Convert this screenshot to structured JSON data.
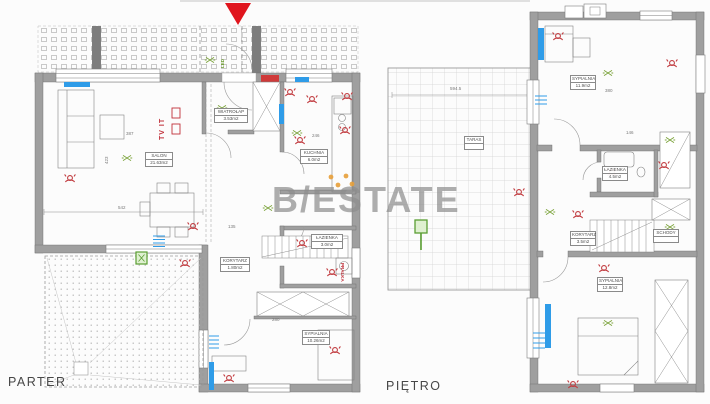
{
  "watermark": {
    "text": "B/ESTATE"
  },
  "colors": {
    "wall_gray": "#9f9f9f",
    "line_gray": "#6a6a6a",
    "symbol_red": "#c13b3f",
    "symbol_green": "#7ba33a",
    "radiator_blue": "#2f9ce8",
    "burner_orange": "#e8a03a",
    "marker_red": "#e0151d",
    "watermark_gray": "#8d8d8d"
  },
  "floors": {
    "parter": {
      "label": "PARTER",
      "rooms": {
        "salon": {
          "name": "SALON",
          "area": "21.63m2"
        },
        "wiatrolap": {
          "name": "WIATROŁAP",
          "area": "3.53m2"
        },
        "kuchnia": {
          "name": "KUCHNIA",
          "area": "6.0m2"
        },
        "korytarz": {
          "name": "KORYTARZ",
          "area": "1.80m2"
        },
        "lazienka": {
          "name": "ŁAZIENKA",
          "area": "3.0m2"
        },
        "sypialnia": {
          "name": "SYPIALNIA",
          "area": "10.26m2"
        }
      },
      "annotations": {
        "tv": "TV IT",
        "led": "LED",
        "pralka": "PRALKA"
      },
      "dims": {
        "d542": "542",
        "d387": "387",
        "d423": "423",
        "d246": "246",
        "d135": "135",
        "d280": "280"
      }
    },
    "pietro": {
      "label": "PIĘTRO",
      "rooms": {
        "sypialnia1": {
          "name": "SYPIALNIA",
          "area": "11.9m2"
        },
        "lazienka": {
          "name": "ŁAZIENKA",
          "area": "4.5m2"
        },
        "korytarz": {
          "name": "KORYTARZ",
          "area": "3.5m2"
        },
        "schody": {
          "name": "SCHODY",
          "area": ""
        },
        "sypialnia2": {
          "name": "SYPIALNIA",
          "area": "12.8m2"
        },
        "taras": {
          "name": "TARAS",
          "area": ""
        }
      },
      "dims": {
        "d5945": "594.5",
        "d380": "380",
        "d146": "146"
      }
    }
  }
}
